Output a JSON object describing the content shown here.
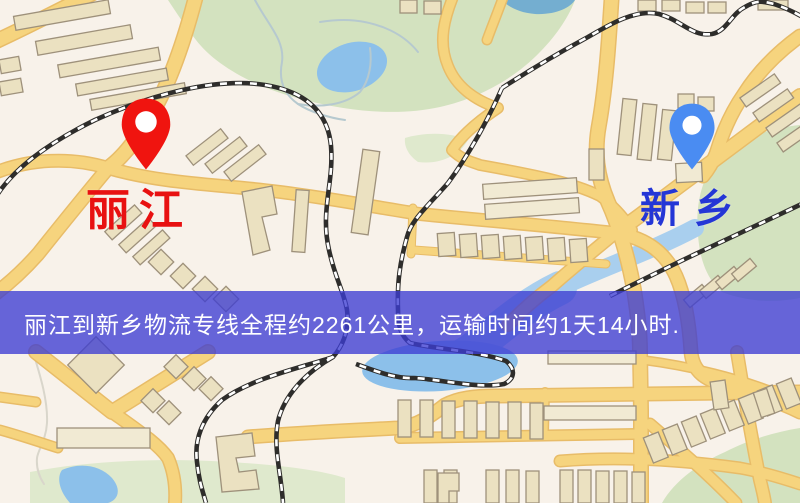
{
  "map": {
    "markers": [
      {
        "id": "origin",
        "label": "丽江",
        "label_color": "#e81111",
        "pin_color": "#f0140f",
        "pin_style": "red-location-pin"
      },
      {
        "id": "destination",
        "label": "新乡",
        "label_color": "#2436d6",
        "pin_color": "#4a8cf2",
        "pin_style": "blue-location-pin"
      }
    ],
    "banner": {
      "text": "丽江到新乡物流专线全程约2261公里，运输时间约1天14小时.",
      "background_color": "#3c3cd2",
      "background_opacity": 0.78,
      "text_color": "#ffffff"
    },
    "palette": {
      "background": "#f8f2ea",
      "road": "#f6d47e",
      "road_casing": "#e8bc68",
      "building": "#ebe1c1",
      "park_green": "#d3e2bf",
      "water_blue": "#8cc0ea",
      "railway_dark": "#2e2d2b"
    }
  }
}
